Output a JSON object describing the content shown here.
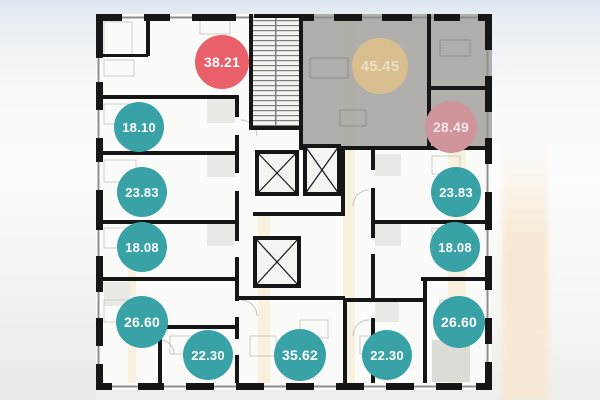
{
  "plan_badges": {
    "units": [
      {
        "area": "38.21",
        "x": 222,
        "y": 62,
        "d": 54,
        "bg": "#e9606a",
        "fg": "#ffffff"
      },
      {
        "area": "45.45",
        "x": 380,
        "y": 66,
        "d": 56,
        "bg": "#d9be8f",
        "fg": "#ece0c2"
      },
      {
        "area": "28.49",
        "x": 451,
        "y": 127,
        "d": 52,
        "bg": "#d0959a",
        "fg": "#f1e6e7"
      },
      {
        "area": "18.10",
        "x": 139,
        "y": 127,
        "d": 50,
        "bg": "#39a2a7",
        "fg": "#ffffff"
      },
      {
        "area": "23.83",
        "x": 142,
        "y": 192,
        "d": 50,
        "bg": "#39a2a7",
        "fg": "#ffffff"
      },
      {
        "area": "18.08",
        "x": 142,
        "y": 247,
        "d": 50,
        "bg": "#39a2a7",
        "fg": "#ffffff"
      },
      {
        "area": "26.60",
        "x": 142,
        "y": 322,
        "d": 52,
        "bg": "#39a2a7",
        "fg": "#ffffff"
      },
      {
        "area": "22.30",
        "x": 208,
        "y": 355,
        "d": 50,
        "bg": "#39a2a7",
        "fg": "#ffffff"
      },
      {
        "area": "35.62",
        "x": 300,
        "y": 355,
        "d": 52,
        "bg": "#39a2a7",
        "fg": "#ffffff"
      },
      {
        "area": "22.30",
        "x": 387,
        "y": 355,
        "d": 50,
        "bg": "#39a2a7",
        "fg": "#ffffff"
      },
      {
        "area": "26.60",
        "x": 459,
        "y": 322,
        "d": 52,
        "bg": "#39a2a7",
        "fg": "#ffffff"
      },
      {
        "area": "18.08",
        "x": 455,
        "y": 247,
        "d": 50,
        "bg": "#39a2a7",
        "fg": "#ffffff"
      },
      {
        "area": "23.83",
        "x": 456,
        "y": 192,
        "d": 50,
        "bg": "#39a2a7",
        "fg": "#ffffff"
      }
    ],
    "colors": {
      "available_badge": "#39a2a7",
      "reserved_badge": "#e9606a",
      "muted_gold_badge": "#d9be8f",
      "muted_rose_badge": "#d0959a",
      "highlighted_unit_fill": "#a7a6a3",
      "wall": "#161616"
    }
  }
}
